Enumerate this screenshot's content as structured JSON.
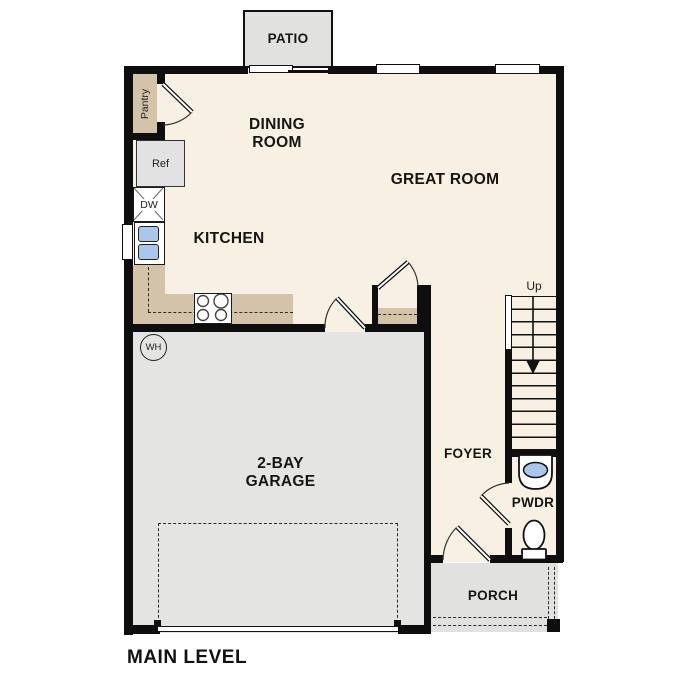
{
  "title": "MAIN LEVEL",
  "rooms": {
    "patio": {
      "label": "PATIO"
    },
    "dining_room": {
      "label": "DINING ROOM"
    },
    "great_room": {
      "label": "GREAT ROOM"
    },
    "kitchen": {
      "label": "KITCHEN"
    },
    "pantry": {
      "label": "Pantry"
    },
    "garage": {
      "label": "2-BAY GARAGE"
    },
    "foyer": {
      "label": "FOYER"
    },
    "powder_room": {
      "label": "PWDR"
    },
    "porch": {
      "label": "PORCH"
    }
  },
  "fixtures": {
    "refrigerator": "Ref",
    "dishwasher": "DW",
    "water_heater": "WH",
    "stairs_direction": "Up"
  },
  "colors": {
    "wall": "#0e0e0e",
    "floor_living": "#f8f0e2",
    "floor_garage": "#e4e4e3",
    "floor_exterior": "#e1e1e0",
    "counter_tan": "#d2c3a9",
    "sink_blue": "#a9c7ea"
  }
}
